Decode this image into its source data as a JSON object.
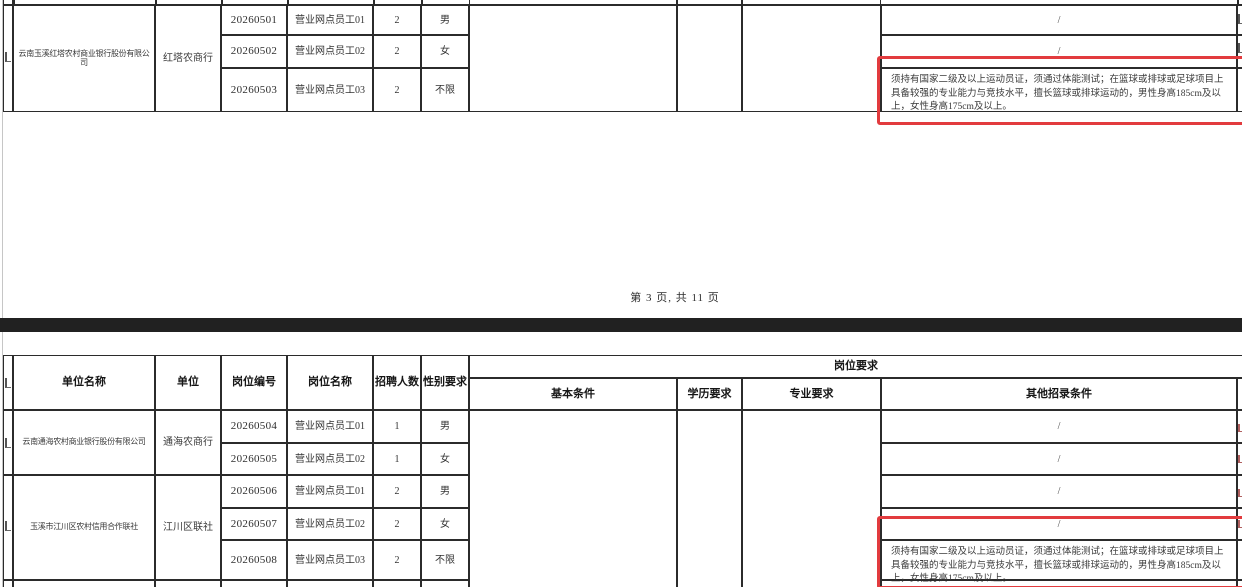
{
  "document": {
    "kind": "recruitment-position-table",
    "page_footer": "第 3 页, 共 11 页"
  },
  "colors": {
    "highlight_red": "#e23b3e",
    "page_separator": "#212121",
    "table_border": "#2b2b2b"
  },
  "headers": {
    "unit_name": "单位名称",
    "unit": "单位",
    "post_code": "岗位编号",
    "post_name": "岗位名称",
    "recruit_count": "招聘人数",
    "gender_req": "性别要求",
    "post_requirements": "岗位要求",
    "basic_conditions": "基本条件",
    "education_req": "学历要求",
    "major_req": "专业要求",
    "other_conditions": "其他招录条件"
  },
  "top_table": {
    "company": "云南玉溪红塔农村商业银行股份有限公司",
    "unit": "红塔农商行",
    "rows": [
      {
        "code": "20260501",
        "post": "营业网点员工01",
        "count": "2",
        "gender": "男",
        "other": "/"
      },
      {
        "code": "20260502",
        "post": "营业网点员工02",
        "count": "2",
        "gender": "女",
        "other": "/"
      },
      {
        "code": "20260503",
        "post": "营业网点员工03",
        "count": "2",
        "gender": "不限",
        "other": "须持有国家二级及以上运动员证，须通过体能测试；在篮球或排球或足球项目上具备较强的专业能力与竞技水平，擅长篮球或排球运动的，男性身高185cm及以上，女性身高175cm及以上。"
      }
    ]
  },
  "bottom_table": {
    "groups": [
      {
        "company": "云南通海农村商业银行股份有限公司",
        "unit": "通海农商行",
        "rows": [
          {
            "code": "20260504",
            "post": "营业网点员工01",
            "count": "1",
            "gender": "男",
            "other": "/"
          },
          {
            "code": "20260505",
            "post": "营业网点员工02",
            "count": "1",
            "gender": "女",
            "other": "/"
          }
        ]
      },
      {
        "company": "玉溪市江川区农村信用合作联社",
        "unit": "江川区联社",
        "rows": [
          {
            "code": "20260506",
            "post": "营业网点员工01",
            "count": "2",
            "gender": "男",
            "other": "/"
          },
          {
            "code": "20260507",
            "post": "营业网点员工02",
            "count": "2",
            "gender": "女",
            "other": "/"
          },
          {
            "code": "20260508",
            "post": "营业网点员工03",
            "count": "2",
            "gender": "不限",
            "other": "须持有国家二级及以上运动员证，须通过体能测试；在篮球或排球或足球项目上具备较强的专业能力与竞技水平，擅长篮球或排球运动的，男性身高185cm及以上，女性身高175cm及以上。"
          }
        ]
      }
    ]
  }
}
